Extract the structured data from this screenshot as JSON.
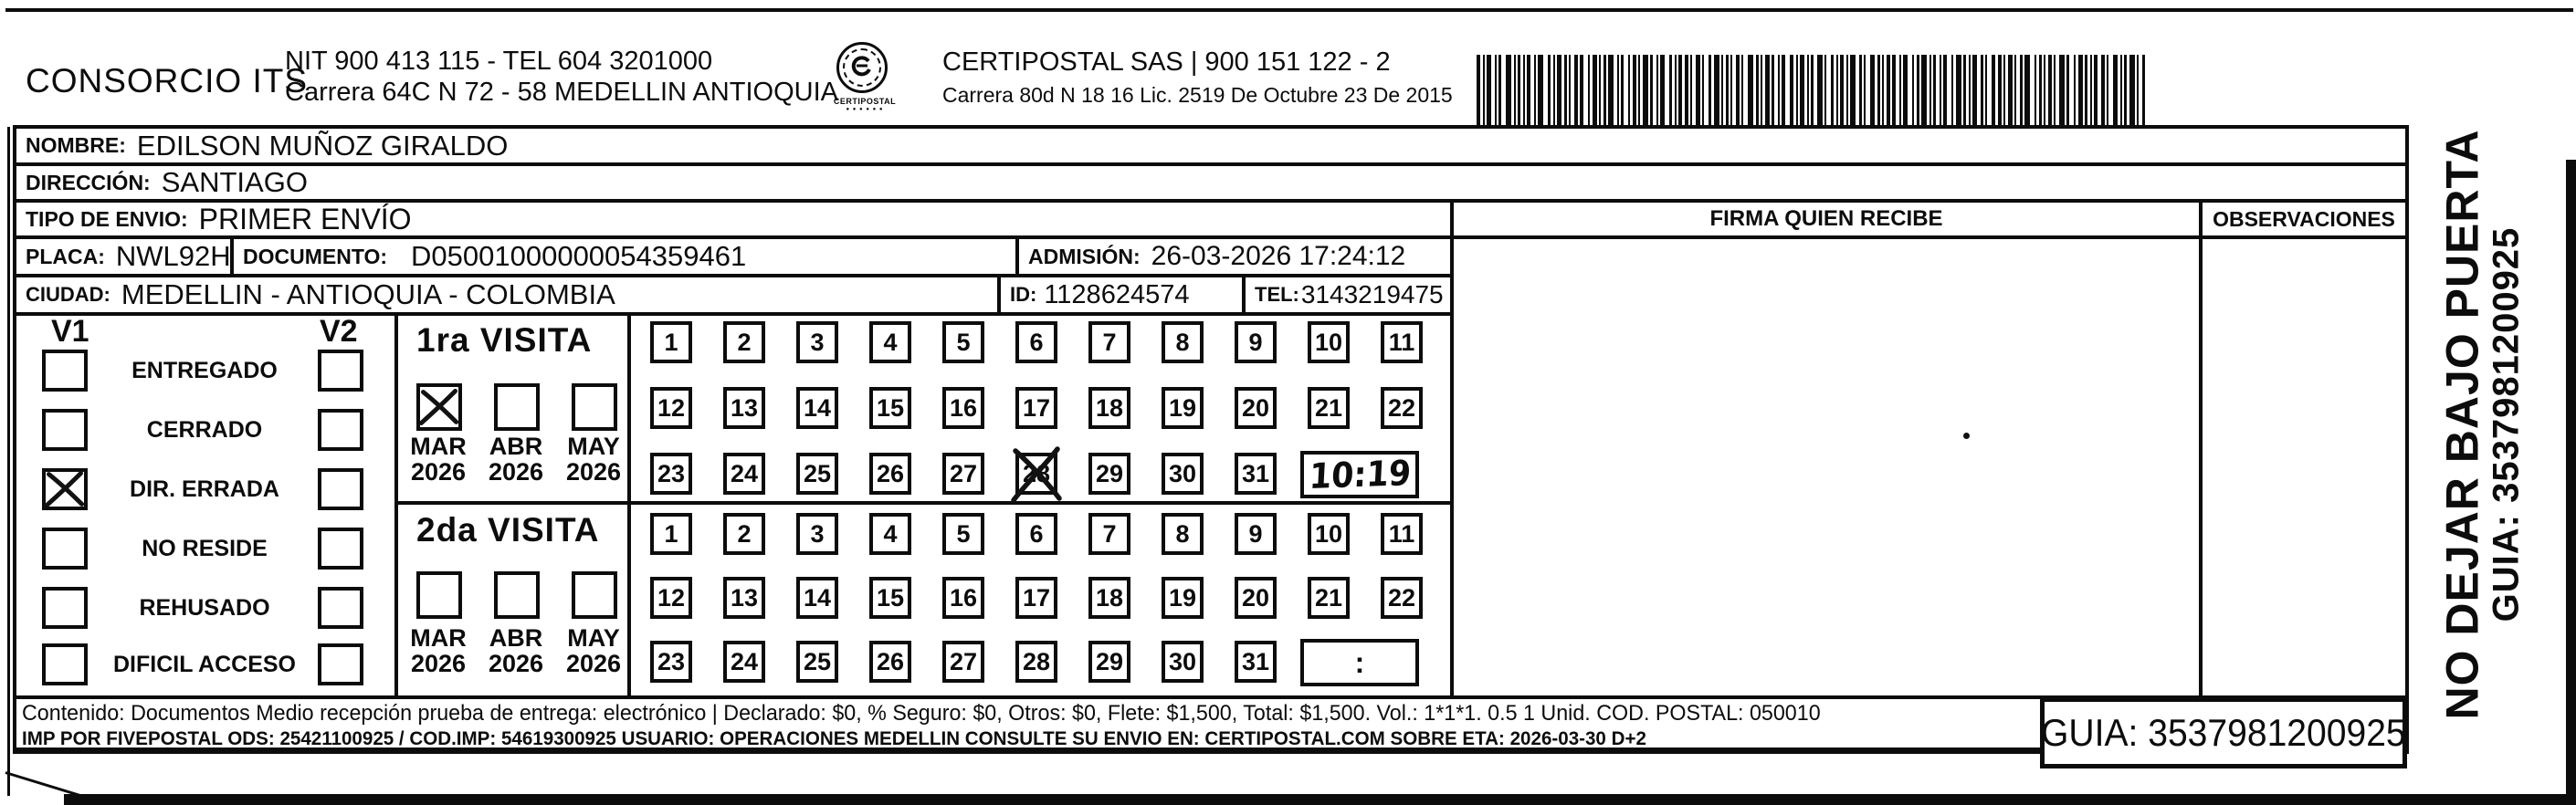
{
  "header": {
    "company": "CONSORCIO ITS",
    "nit_line": "NIT 900 413 115 - TEL 604 3201000",
    "address_line": "Carrera 64C N 72 - 58 MEDELLIN ANTIOQUIA",
    "logo_caption": "CERTIPOSTAL",
    "certipostal_line": "CERTIPOSTAL SAS | 900 151 122 - 2",
    "certipostal_address": "Carrera 80d N 18 16  Lic. 2519 De Octubre 23 De 2015"
  },
  "shipment": {
    "nombre_label": "NOMBRE:",
    "nombre": "EDILSON MUÑOZ GIRALDO",
    "direccion_label": "DIRECCIÓN:",
    "direccion": "SANTIAGO",
    "tipo_label": "TIPO DE ENVIO:",
    "tipo": "PRIMER ENVÍO",
    "placa_label": "PLACA:",
    "placa": "NWL92H",
    "documento_label": "DOCUMENTO:",
    "documento": "D05001000000054359461",
    "admision_label": "ADMISIÓN:",
    "admision": "26-03-2026 17:24:12",
    "ciudad_label": "CIUDAD:",
    "ciudad": "MEDELLIN - ANTIOQUIA - COLOMBIA",
    "id_label": "ID:",
    "id_value": "1128624574",
    "tel_label": "TEL:",
    "tel": "3143219475"
  },
  "signature": {
    "firma_header": "FIRMA QUIEN RECIBE",
    "observaciones_header": "OBSERVACIONES"
  },
  "status": {
    "v1_label": "V1",
    "v2_label": "V2",
    "options": [
      "ENTREGADO",
      "CERRADO",
      "DIR. ERRADA",
      "NO RESIDE",
      "REHUSADO",
      "DIFICIL ACCESO"
    ],
    "v1_checked_option": "DIR. ERRADA"
  },
  "visits": {
    "first": {
      "title": "1ra VISITA",
      "months": [
        "MAR",
        "ABR",
        "MAY"
      ],
      "years": [
        "2026",
        "2026",
        "2026"
      ],
      "checked_month": "MAR",
      "days": [
        1,
        2,
        3,
        4,
        5,
        6,
        7,
        8,
        9,
        10,
        11,
        12,
        13,
        14,
        15,
        16,
        17,
        18,
        19,
        20,
        21,
        22,
        23,
        24,
        25,
        26,
        27,
        28,
        29,
        30,
        31
      ],
      "crossed_day": 28,
      "handwritten_time": "10:19"
    },
    "second": {
      "title": "2da VISITA",
      "months": [
        "MAR",
        "ABR",
        "MAY"
      ],
      "years": [
        "2026",
        "2026",
        "2026"
      ],
      "days": [
        1,
        2,
        3,
        4,
        5,
        6,
        7,
        8,
        9,
        10,
        11,
        12,
        13,
        14,
        15,
        16,
        17,
        18,
        19,
        20,
        21,
        22,
        23,
        24,
        25,
        26,
        27,
        28,
        29,
        30,
        31
      ],
      "time_placeholder": ":"
    }
  },
  "side_note": {
    "line1": "NO DEJAR BAJO PUERTA",
    "line2": "GUIA: 3537981200925"
  },
  "footer": {
    "content_line": "Contenido: Documentos Medio recepción prueba de entrega: electrónico | Declarado: $0, % Seguro: $0, Otros: $0, Flete: $1,500, Total: $1,500. Vol.: 1*1*1. 0.5 1 Unid. COD. POSTAL: 050010",
    "imp_line": "IMP POR FIVEPOSTAL ODS: 25421100925 / COD.IMP: 54619300925 USUARIO: OPERACIONES MEDELLIN CONSULTE SU ENVIO EN: CERTIPOSTAL.COM SOBRE ETA: 2026-03-30 D+2",
    "guia_box": "GUIA: 3537981200925"
  }
}
